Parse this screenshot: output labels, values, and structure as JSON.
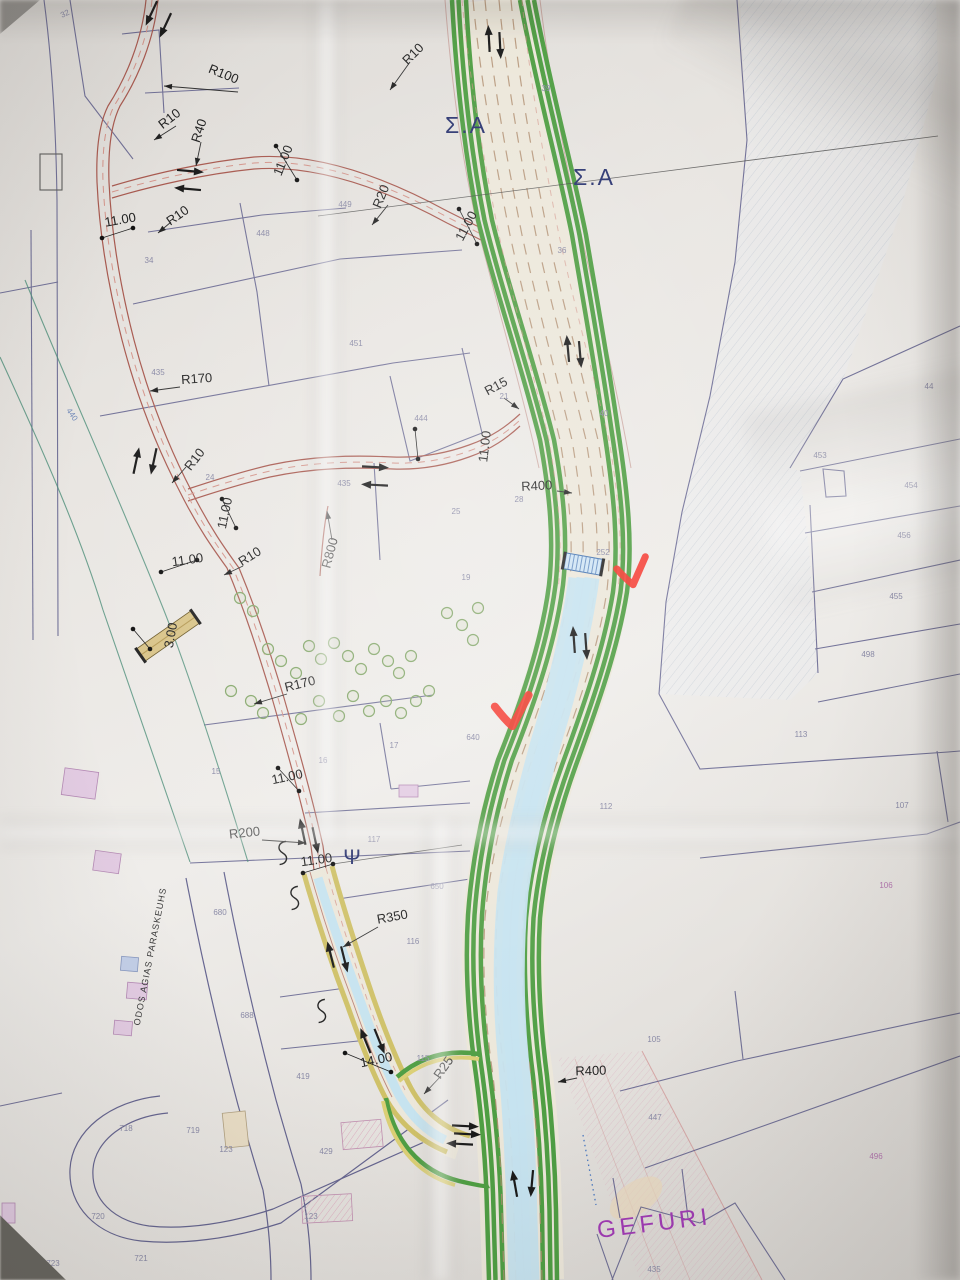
{
  "document": {
    "kind": "photo of printed road design plan",
    "language": "Greek engineering drawing",
    "main_road_name": "GEFURI corridor"
  },
  "colors": {
    "paper": "#e9e6e2",
    "road_green": "#4f9e43",
    "road_green_light": "#9ec46b",
    "road_yellow": "#dbcf75",
    "river_cyan": "#c6e3ef",
    "old_road_red": "#a85a50",
    "parcel_line": "#4c4c80",
    "label_black": "#232323",
    "label_navy": "#2a3470",
    "label_purple": "#a03ab4",
    "parcel_num": "#8a8aa6",
    "red_mark": "#f5352b"
  },
  "labels": {
    "engineering": [
      {
        "t": "R100",
        "x": 222,
        "y": 78,
        "r": 22
      },
      {
        "t": "R10",
        "x": 172,
        "y": 122,
        "r": -38
      },
      {
        "t": "R40",
        "x": 203,
        "y": 132,
        "r": -72
      },
      {
        "t": "11.00",
        "x": 287,
        "y": 162,
        "r": -68
      },
      {
        "t": "11.00",
        "x": 121,
        "y": 224,
        "r": -10
      },
      {
        "t": "R10",
        "x": 180,
        "y": 219,
        "r": -35
      },
      {
        "t": "R10",
        "x": 416,
        "y": 57,
        "r": -45
      },
      {
        "t": "R20",
        "x": 385,
        "y": 198,
        "r": -68
      },
      {
        "t": "11.00",
        "x": 470,
        "y": 228,
        "r": -62
      },
      {
        "t": "R170",
        "x": 197,
        "y": 383,
        "r": -4
      },
      {
        "t": "R15",
        "x": 498,
        "y": 390,
        "r": -28
      },
      {
        "t": "11.00",
        "x": 489,
        "y": 447,
        "r": -83
      },
      {
        "t": "R400",
        "x": 537,
        "y": 490,
        "r": -3
      },
      {
        "t": "R10",
        "x": 198,
        "y": 462,
        "r": -52
      },
      {
        "t": "11.00",
        "x": 229,
        "y": 514,
        "r": -78
      },
      {
        "t": "11.00",
        "x": 188,
        "y": 564,
        "r": -8
      },
      {
        "t": "R10",
        "x": 252,
        "y": 560,
        "r": -32
      },
      {
        "t": "R800",
        "x": 334,
        "y": 554,
        "r": -75
      },
      {
        "t": "3.00",
        "x": 175,
        "y": 636,
        "r": -80
      },
      {
        "t": "R170",
        "x": 301,
        "y": 688,
        "r": -14
      },
      {
        "t": "11.00",
        "x": 288,
        "y": 781,
        "r": -12
      },
      {
        "t": "R200",
        "x": 245,
        "y": 837,
        "r": -6
      },
      {
        "t": "11.00",
        "x": 317,
        "y": 864,
        "r": -8
      },
      {
        "t": "R350",
        "x": 393,
        "y": 921,
        "r": -10
      },
      {
        "t": "14.00",
        "x": 377,
        "y": 1064,
        "r": -12
      },
      {
        "t": "R25",
        "x": 447,
        "y": 1070,
        "r": -55
      },
      {
        "t": "R400",
        "x": 591,
        "y": 1075,
        "r": -2
      }
    ],
    "stations": [
      {
        "t": "Σ.Α",
        "x": 466,
        "y": 133,
        "r": 0,
        "s": 23,
        "c": "#2a3470",
        "ls": 2
      },
      {
        "t": "Σ.Α",
        "x": 594,
        "y": 185,
        "r": 0,
        "s": 23,
        "c": "#2a3470",
        "ls": 2
      },
      {
        "t": "Ψ",
        "x": 352,
        "y": 864,
        "r": 0,
        "s": 21,
        "c": "#2a3470",
        "ls": 0
      },
      {
        "t": "GEFURI",
        "x": 655,
        "y": 1231,
        "r": -7,
        "s": 24,
        "c": "#a03ab4",
        "ls": 4
      }
    ],
    "street_name": {
      "t": "ODOS AGIAS PARASKEUHS",
      "x": 153,
      "y": 957,
      "r": -79,
      "s": 9,
      "c": "#3a3a3a",
      "ls": 1
    },
    "parcels": [
      {
        "t": "32",
        "x": 66,
        "y": 16,
        "r": -25
      },
      {
        "t": "39",
        "x": 546,
        "y": 91
      },
      {
        "t": "36",
        "x": 562,
        "y": 253
      },
      {
        "t": "34",
        "x": 149,
        "y": 263
      },
      {
        "t": "449",
        "x": 345,
        "y": 207
      },
      {
        "t": "448",
        "x": 263,
        "y": 236
      },
      {
        "t": "451",
        "x": 356,
        "y": 346
      },
      {
        "t": "435",
        "x": 158,
        "y": 375
      },
      {
        "t": "444",
        "x": 421,
        "y": 421
      },
      {
        "t": "21",
        "x": 504,
        "y": 399
      },
      {
        "t": "40",
        "x": 604,
        "y": 416
      },
      {
        "t": "44",
        "x": 929,
        "y": 389
      },
      {
        "t": "453",
        "x": 820,
        "y": 458
      },
      {
        "t": "454",
        "x": 911,
        "y": 488
      },
      {
        "t": "456",
        "x": 904,
        "y": 538
      },
      {
        "t": "455",
        "x": 896,
        "y": 599
      },
      {
        "t": "498",
        "x": 868,
        "y": 657
      },
      {
        "t": "435",
        "x": 344,
        "y": 486
      },
      {
        "t": "25",
        "x": 456,
        "y": 514
      },
      {
        "t": "28",
        "x": 519,
        "y": 502
      },
      {
        "t": "24",
        "x": 210,
        "y": 480
      },
      {
        "t": "19",
        "x": 466,
        "y": 580
      },
      {
        "t": "252",
        "x": 603,
        "y": 555
      },
      {
        "t": "640",
        "x": 473,
        "y": 740
      },
      {
        "t": "112",
        "x": 606,
        "y": 809
      },
      {
        "t": "113",
        "x": 801,
        "y": 737
      },
      {
        "t": "107",
        "x": 902,
        "y": 808
      },
      {
        "t": "106",
        "x": 886,
        "y": 888,
        "c": "#b276ae"
      },
      {
        "t": "117",
        "x": 374,
        "y": 842
      },
      {
        "t": "15",
        "x": 216,
        "y": 774
      },
      {
        "t": "16",
        "x": 323,
        "y": 763
      },
      {
        "t": "17",
        "x": 394,
        "y": 748
      },
      {
        "t": "650",
        "x": 437,
        "y": 889
      },
      {
        "t": "680",
        "x": 220,
        "y": 915
      },
      {
        "t": "688",
        "x": 247,
        "y": 1018
      },
      {
        "t": "116",
        "x": 413,
        "y": 944
      },
      {
        "t": "115",
        "x": 423,
        "y": 1061
      },
      {
        "t": "419",
        "x": 303,
        "y": 1079
      },
      {
        "t": "718",
        "x": 126,
        "y": 1131
      },
      {
        "t": "719",
        "x": 193,
        "y": 1133
      },
      {
        "t": "123",
        "x": 226,
        "y": 1152
      },
      {
        "t": "429",
        "x": 326,
        "y": 1154
      },
      {
        "t": "720",
        "x": 98,
        "y": 1219
      },
      {
        "t": "721",
        "x": 141,
        "y": 1261
      },
      {
        "t": "723",
        "x": 53,
        "y": 1266
      },
      {
        "t": "123",
        "x": 311,
        "y": 1219
      },
      {
        "t": "105",
        "x": 654,
        "y": 1042
      },
      {
        "t": "447",
        "x": 655,
        "y": 1120
      },
      {
        "t": "496",
        "x": 876,
        "y": 1159,
        "c": "#b276ae"
      },
      {
        "t": "435",
        "x": 654,
        "y": 1272
      },
      {
        "t": "440",
        "x": 70,
        "y": 416,
        "r": 55,
        "c": "#6f87b8"
      }
    ]
  },
  "symbols": {
    "red_checks": [
      {
        "x": 630,
        "y": 570,
        "r": -8,
        "s": 1.0
      },
      {
        "x": 510,
        "y": 709,
        "r": -4,
        "s": 1.15
      }
    ],
    "arrows": [
      {
        "x": 152,
        "y": 12,
        "a": 115
      },
      {
        "x": 166,
        "y": 24,
        "a": 115
      },
      {
        "x": 189,
        "y": 171,
        "a": 5
      },
      {
        "x": 189,
        "y": 189,
        "a": 185
      },
      {
        "x": 489,
        "y": 40,
        "a": -93
      },
      {
        "x": 500,
        "y": 44,
        "a": 87
      },
      {
        "x": 568,
        "y": 350,
        "a": -95
      },
      {
        "x": 580,
        "y": 353,
        "a": 85
      },
      {
        "x": 136,
        "y": 462,
        "a": -78
      },
      {
        "x": 154,
        "y": 460,
        "a": 102
      },
      {
        "x": 374,
        "y": 467,
        "a": 3
      },
      {
        "x": 376,
        "y": 485,
        "a": 183
      },
      {
        "x": 574,
        "y": 641,
        "a": -94
      },
      {
        "x": 586,
        "y": 645,
        "a": 86
      },
      {
        "x": 303,
        "y": 833,
        "a": -102
      },
      {
        "x": 315,
        "y": 839,
        "a": 78
      },
      {
        "x": 331,
        "y": 956,
        "a": -104
      },
      {
        "x": 344,
        "y": 958,
        "a": 76
      },
      {
        "x": 366,
        "y": 1042,
        "a": -112
      },
      {
        "x": 379,
        "y": 1040,
        "a": 68
      },
      {
        "x": 464,
        "y": 1126,
        "a": 3
      },
      {
        "x": 466,
        "y": 1134,
        "a": 3
      },
      {
        "x": 461,
        "y": 1144,
        "a": 183
      },
      {
        "x": 515,
        "y": 1185,
        "a": -100
      },
      {
        "x": 532,
        "y": 1182,
        "a": 95
      }
    ],
    "trees": [
      [
        240,
        598
      ],
      [
        253,
        611
      ],
      [
        268,
        649
      ],
      [
        281,
        661
      ],
      [
        251,
        701
      ],
      [
        263,
        713
      ],
      [
        296,
        673
      ],
      [
        309,
        646
      ],
      [
        321,
        659
      ],
      [
        334,
        643
      ],
      [
        348,
        656
      ],
      [
        361,
        669
      ],
      [
        374,
        649
      ],
      [
        388,
        661
      ],
      [
        399,
        673
      ],
      [
        411,
        656
      ],
      [
        353,
        696
      ],
      [
        369,
        711
      ],
      [
        386,
        701
      ],
      [
        401,
        713
      ],
      [
        339,
        716
      ],
      [
        319,
        701
      ],
      [
        416,
        701
      ],
      [
        429,
        691
      ],
      [
        231,
        691
      ],
      [
        301,
        719
      ],
      [
        447,
        613
      ],
      [
        462,
        625
      ],
      [
        473,
        640
      ],
      [
        478,
        608
      ]
    ],
    "squiggles": [
      [
        283,
        852
      ],
      [
        295,
        897
      ],
      [
        322,
        1010
      ]
    ],
    "leaders": [
      [
        238,
        92,
        164,
        86
      ],
      [
        201,
        142,
        196,
        166
      ],
      [
        176,
        126,
        154,
        140
      ],
      [
        410,
        62,
        390,
        90
      ],
      [
        388,
        205,
        372,
        225
      ],
      [
        180,
        387,
        150,
        391
      ],
      [
        504,
        398,
        519,
        409
      ],
      [
        557,
        491,
        572,
        493
      ],
      [
        186,
        467,
        172,
        483
      ],
      [
        243,
        566,
        224,
        575
      ],
      [
        332,
        540,
        327,
        511
      ],
      [
        287,
        694,
        254,
        704
      ],
      [
        262,
        840,
        306,
        843
      ],
      [
        378,
        927,
        343,
        947
      ],
      [
        441,
        1076,
        424,
        1094
      ],
      [
        577,
        1078,
        558,
        1082
      ],
      [
        171,
        222,
        158,
        233
      ]
    ],
    "dim_pairs": [
      [
        102,
        238,
        133,
        228
      ],
      [
        276,
        146,
        297,
        180
      ],
      [
        459,
        209,
        477,
        244
      ],
      [
        415,
        429,
        418,
        459
      ],
      [
        222,
        499,
        236,
        528
      ],
      [
        161,
        572,
        197,
        560
      ],
      [
        278,
        768,
        299,
        791
      ],
      [
        303,
        873,
        333,
        864
      ],
      [
        345,
        1053,
        391,
        1072
      ],
      [
        133,
        629,
        150,
        649
      ]
    ],
    "buildings": [
      {
        "x": 63,
        "y": 770,
        "w": 34,
        "h": 27,
        "r": 8,
        "f": "lav"
      },
      {
        "x": 94,
        "y": 852,
        "w": 26,
        "h": 20,
        "r": 8,
        "f": "lav"
      },
      {
        "x": 121,
        "y": 957,
        "w": 17,
        "h": 14,
        "r": 5,
        "f": "blue"
      },
      {
        "x": 127,
        "y": 983,
        "w": 20,
        "h": 16,
        "r": 5,
        "f": "lav"
      },
      {
        "x": 114,
        "y": 1021,
        "w": 18,
        "h": 14,
        "r": 5,
        "f": "lav"
      },
      {
        "x": 224,
        "y": 1112,
        "w": 23,
        "h": 35,
        "r": -6,
        "f": "tan"
      },
      {
        "x": 342,
        "y": 1121,
        "w": 40,
        "h": 27,
        "r": -5,
        "f": "ph"
      },
      {
        "x": 302,
        "y": 1195,
        "w": 50,
        "h": 27,
        "r": -3,
        "f": "ph"
      },
      {
        "x": 399,
        "y": 785,
        "w": 19,
        "h": 12,
        "r": 0,
        "f": "lav"
      },
      {
        "x": 2,
        "y": 1203,
        "w": 13,
        "h": 20,
        "r": 0,
        "f": "lav"
      }
    ]
  }
}
